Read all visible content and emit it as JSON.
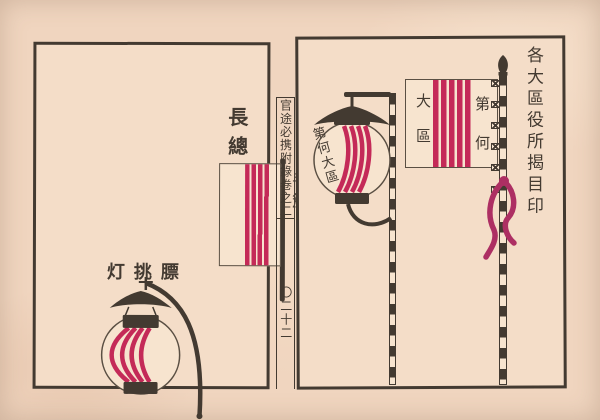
{
  "page": {
    "paper_color": "#f0d5bf",
    "panel_paper_color": "#f4ddc8",
    "ink_color": "#433a31",
    "stripe_red": "#c42a58",
    "tassel_magenta": "#ad2f63"
  },
  "spine": {
    "book_title": "官途必携附錄卷之二",
    "page_number": "〇二十二"
  },
  "left_panel": {
    "heading": "長總",
    "hand_flag_label": "手簱",
    "lantern_label": "灯挑膘"
  },
  "right_panel": {
    "caption": "各大區役所揭目印",
    "lantern_text": "第何大區",
    "flag_text_left": "大區",
    "flag_text_right": "第何"
  }
}
